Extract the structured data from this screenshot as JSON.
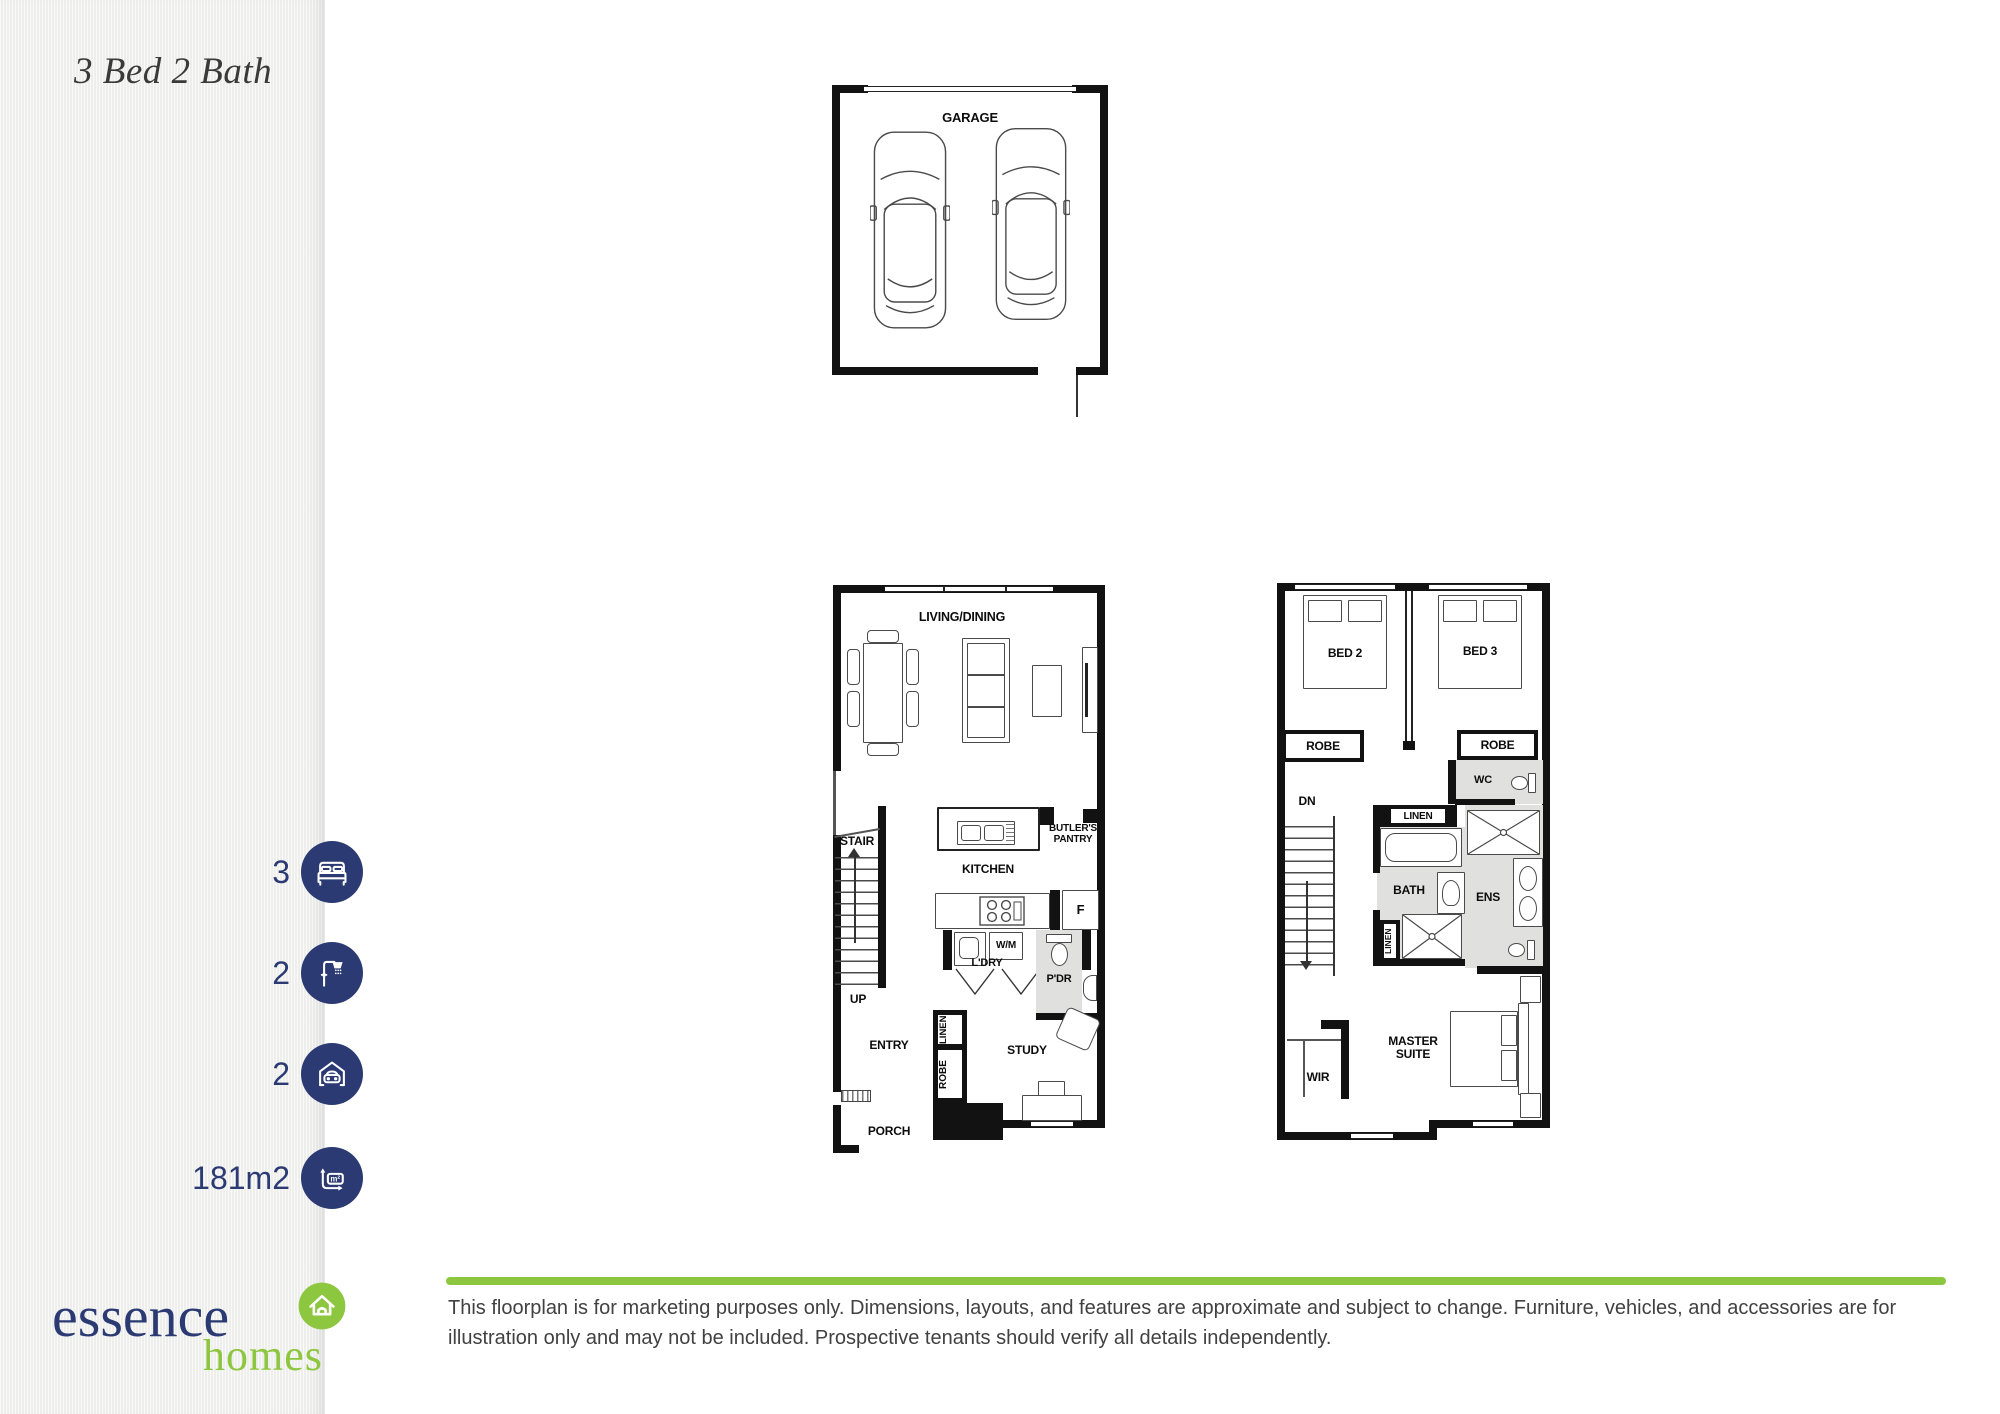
{
  "sidebar": {
    "title": "3 Bed 2 Bath",
    "stats": [
      {
        "value": "3",
        "icon": "bed-icon"
      },
      {
        "value": "2",
        "icon": "shower-icon"
      },
      {
        "value": "2",
        "icon": "car-garage-icon"
      },
      {
        "value": "181m2",
        "icon": "area-icon"
      }
    ],
    "logo": {
      "brand": "essence",
      "sub": "homes",
      "icon": "house-icon"
    }
  },
  "plans": {
    "garage": {
      "title": "GARAGE"
    },
    "ground": {
      "living_dining": "LIVING/DINING",
      "stair": "STAIR",
      "up": "UP",
      "kitchen": "KITCHEN",
      "butlers_pantry": "BUTLER'S\nPANTRY",
      "fridge": "F",
      "wm": "W/M",
      "ldry": "L'DRY",
      "pdr": "P'DR",
      "entry": "ENTRY",
      "linen": "LINEN",
      "robe": "ROBE",
      "study": "STUDY",
      "porch": "PORCH"
    },
    "upper": {
      "bed2": "BED 2",
      "bed3": "BED 3",
      "robe_left": "ROBE",
      "robe_right": "ROBE",
      "wc": "WC",
      "dn": "DN",
      "linen_top": "LINEN",
      "bath": "BATH",
      "ens": "ENS",
      "linen_side": "LINEN",
      "wir": "WIR",
      "master_suite": "MASTER SUITE"
    }
  },
  "footer": {
    "disclaimer": "This floorplan is for marketing purposes only. Dimensions, layouts, and features are approximate and subject to change. Furniture, vehicles, and accessories are for illustration only and may not be included. Prospective tenants should verify all details independently."
  },
  "colors": {
    "navy": "#2b3a72",
    "green": "#8dc63f",
    "wall": "#121212",
    "wet_area": "#e0e0df",
    "text": "#414141"
  }
}
